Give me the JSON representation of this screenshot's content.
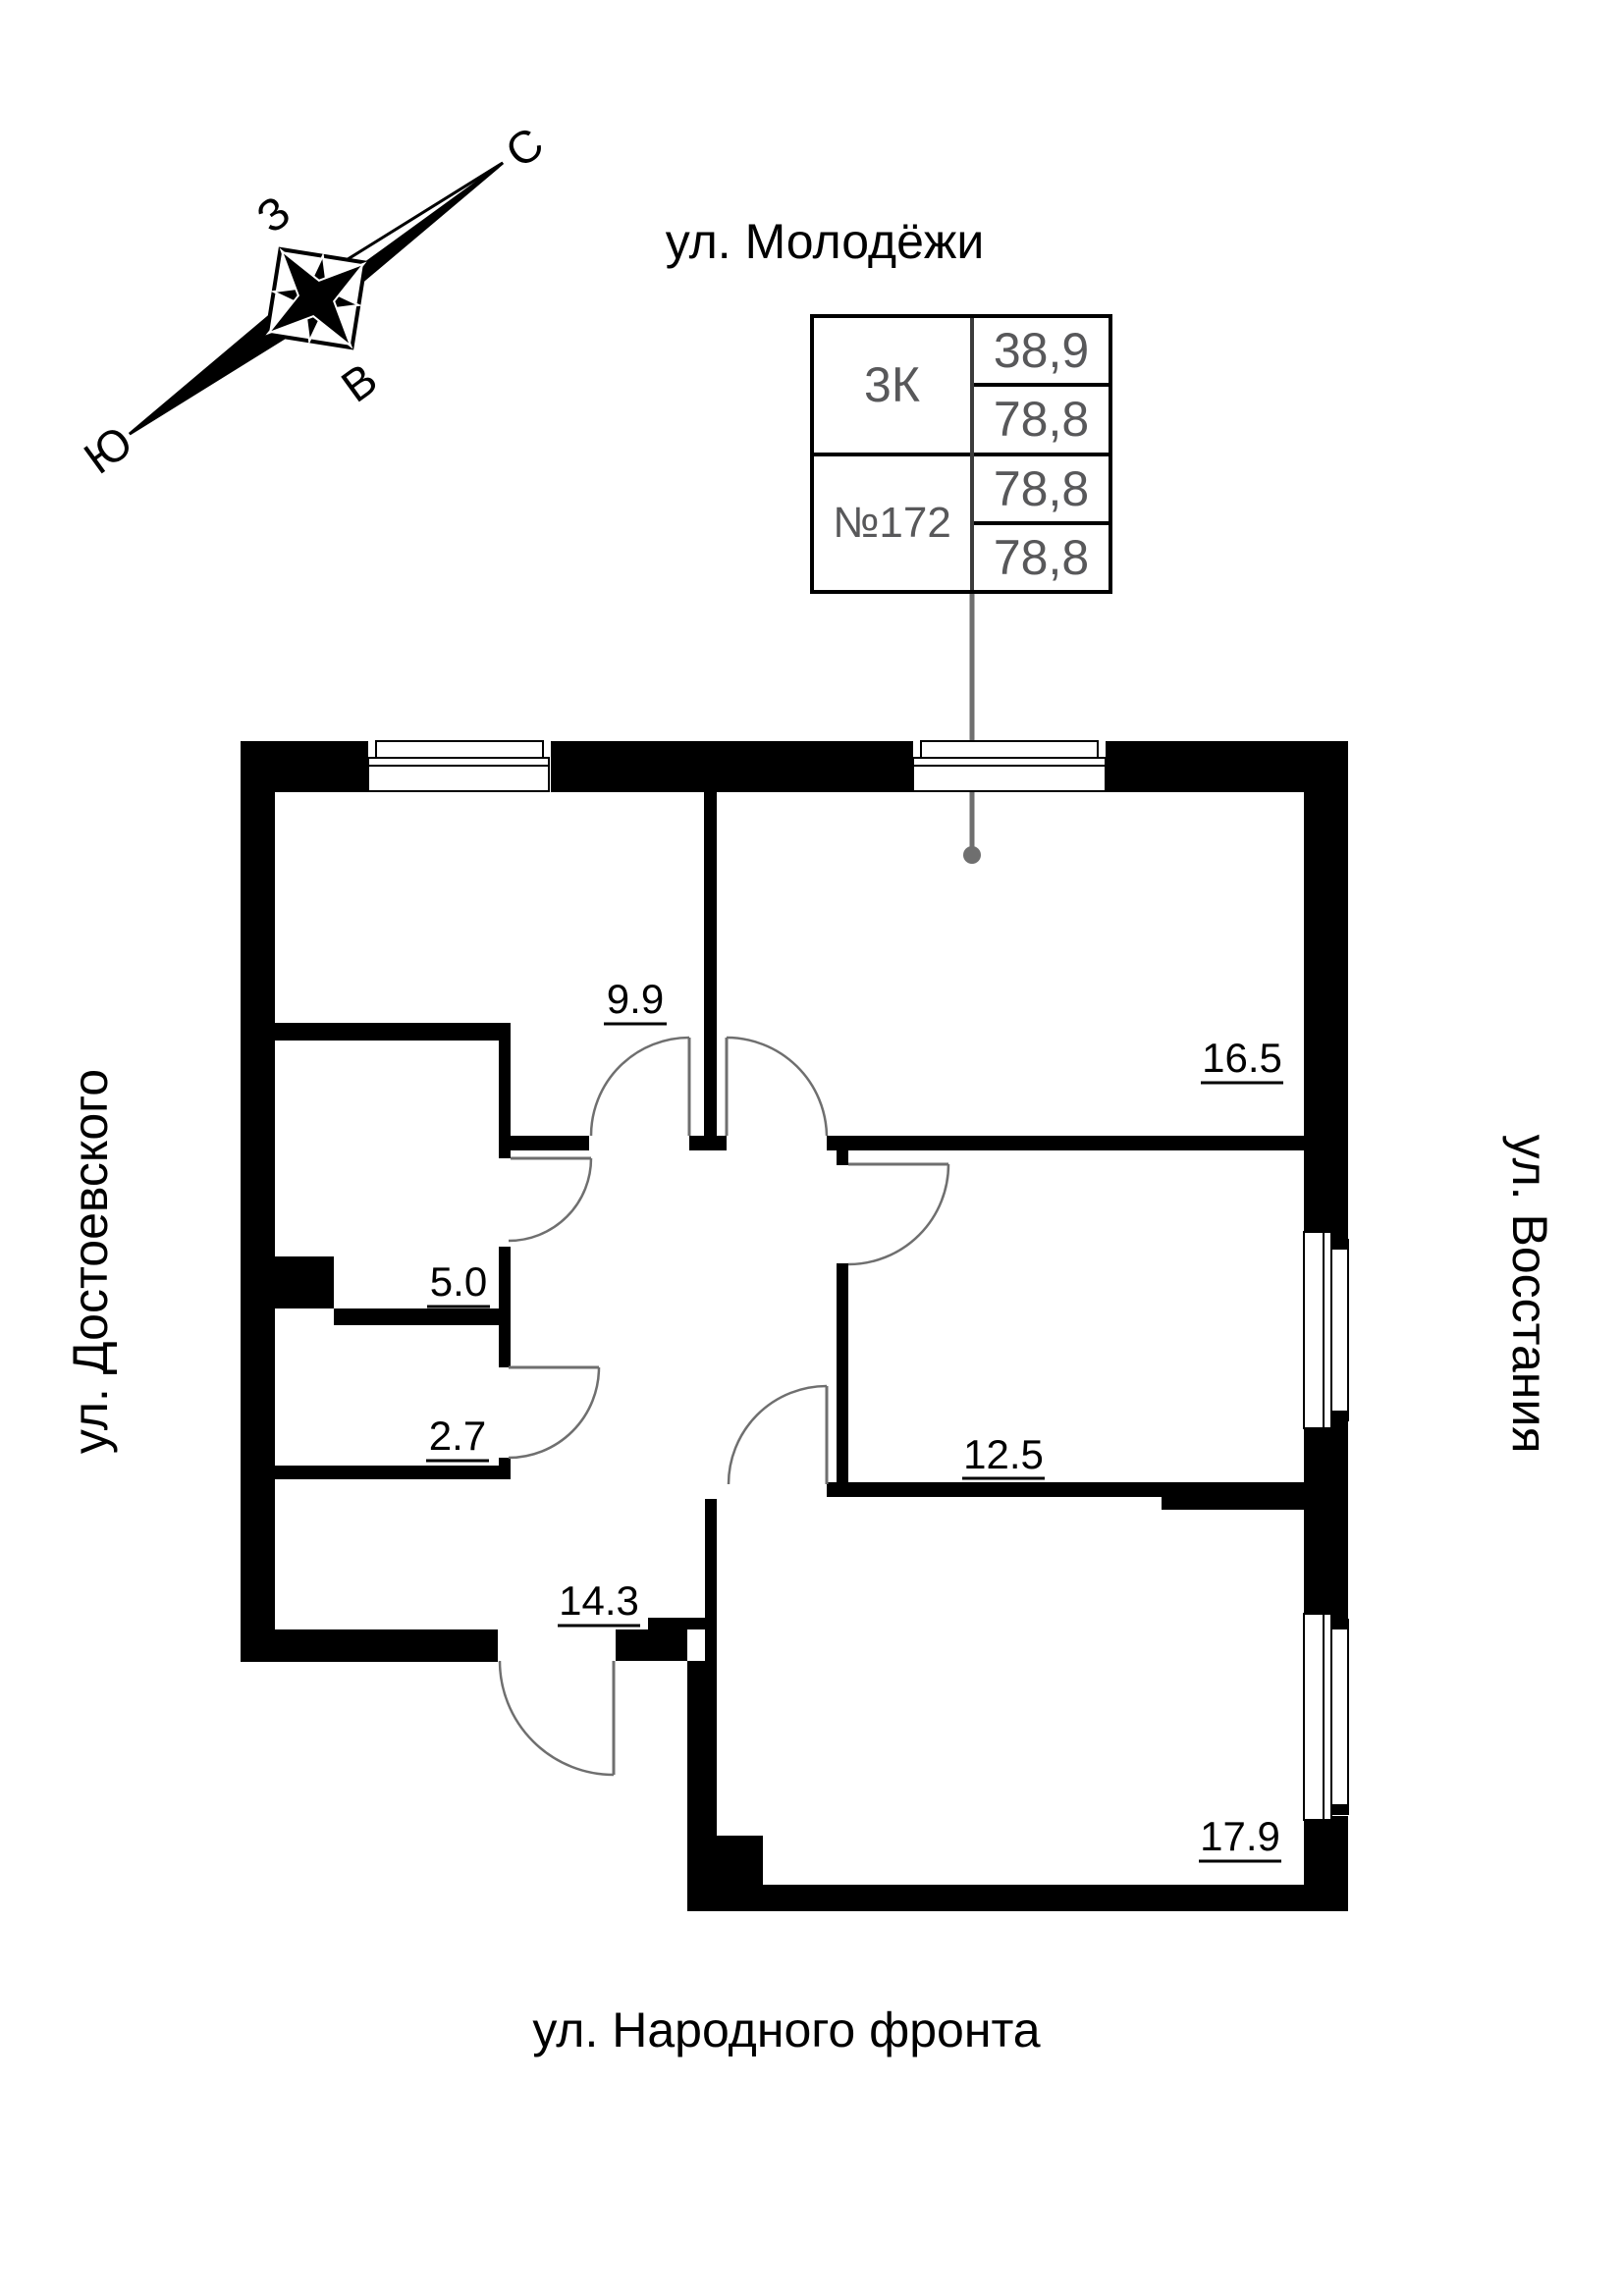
{
  "streets": {
    "top": "ул. Молодёжи",
    "bottom": "ул. Народного фронта",
    "left": "ул. Достоевского",
    "right": "ул. Восстания"
  },
  "compass": {
    "north": "С",
    "south": "Ю",
    "west": "З",
    "east": "В"
  },
  "info_table": {
    "plan_type": "3К",
    "apartment_number": "№172",
    "values": [
      "38,9",
      "78,8",
      "78,8",
      "78,8"
    ]
  },
  "rooms": [
    {
      "area": "9.9"
    },
    {
      "area": "16.5"
    },
    {
      "area": "5.0"
    },
    {
      "area": "2.7"
    },
    {
      "area": "12.5"
    },
    {
      "area": "14.3"
    },
    {
      "area": "17.9"
    }
  ],
  "colors": {
    "walls": "#000000",
    "door_arc": "#6f6f6f",
    "leader": "#6f6f6f",
    "table_text": "#58585a"
  }
}
